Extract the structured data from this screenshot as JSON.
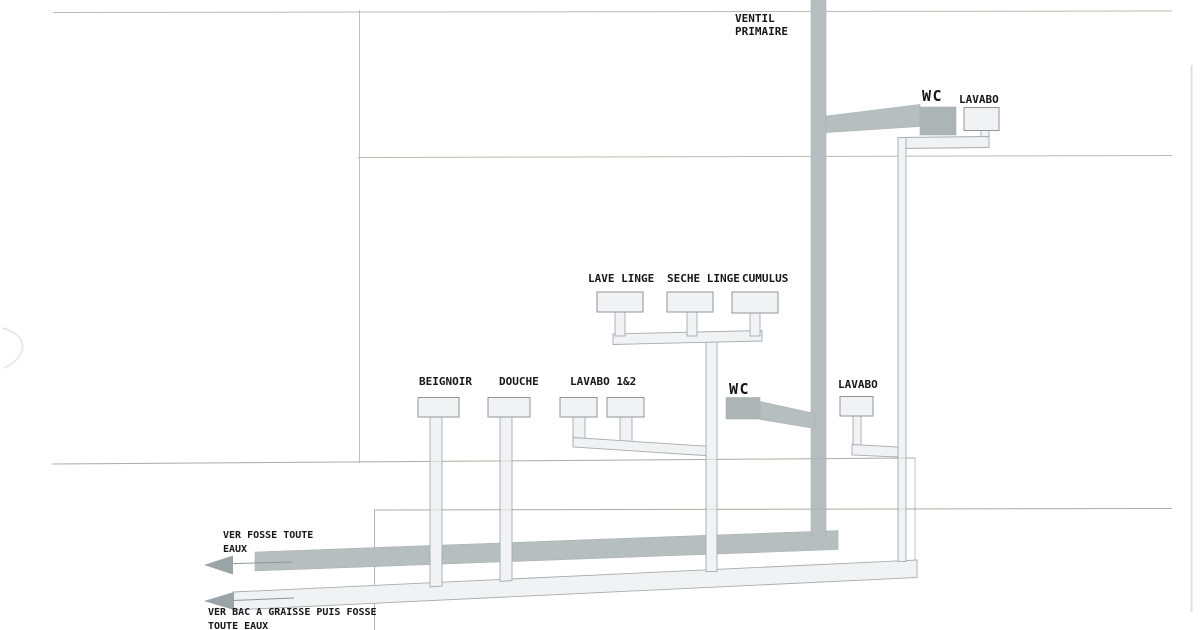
{
  "diagram_type": "plumbing-sanitary-schematic",
  "labels": {
    "ventil_line1": "VENTIL",
    "ventil_line2": "PRIMAIRE",
    "upper_wc": "WC",
    "upper_lavabo": "LAVABO",
    "lave_linge": "LAVE LINGE",
    "seche_linge": "SECHE LINGE",
    "cumulus": "CUMULUS",
    "beignoir": "BEIGNOIR",
    "douche": "DOUCHE",
    "lavabo_12": "LAVABO 1&2",
    "lower_wc": "WC",
    "lower_lavabo": "LAVABO",
    "outlet_fosse_line1": "VER FOSSE TOUTE",
    "outlet_fosse_line2": "EAUX",
    "outlet_graisse_line1": "VER BAC A GRAISSE PUIS FOSSE",
    "outlet_graisse_line2": "TOUTE EAUX"
  },
  "icons": {
    "flow_arrow_fosse": "left-arrow",
    "flow_arrow_graisse": "left-arrow"
  },
  "colors": {
    "background": "#ffffff",
    "gray_pipe_fill": "#b7bec0",
    "gray_unit_fill": "#acb4b6",
    "light_pipe_fill": "#f0f2f3",
    "light_pipe_stroke": "#a6acb0",
    "unit_box_fill": "#f1f2f3",
    "unit_box_stroke": "#8f969b",
    "construction_line": "#a2a29a",
    "arrow_fill": "#9aa3a5",
    "text": "#17171c"
  }
}
